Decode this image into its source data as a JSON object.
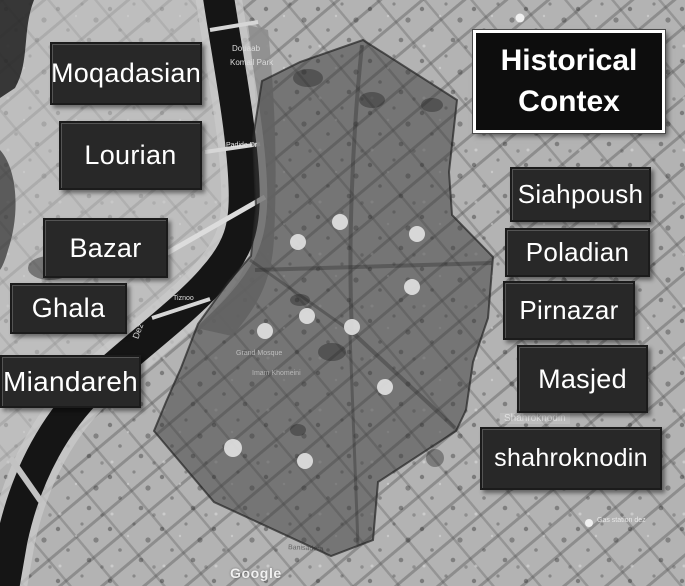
{
  "figure": {
    "title": "Historical Contex"
  },
  "regions_left": [
    {
      "name": "Moqadasian"
    },
    {
      "name": "Lourian"
    },
    {
      "name": "Bazar"
    },
    {
      "name": "Ghala"
    },
    {
      "name": "Miandareh"
    }
  ],
  "regions_right": [
    {
      "name": "Siahpoush"
    },
    {
      "name": "Poladian"
    },
    {
      "name": "Pirnazar"
    },
    {
      "name": "Masjed"
    },
    {
      "name": "shahroknodin"
    }
  ],
  "map_labels": {
    "park_line1": "Douaab",
    "park_line2": "Komail Park",
    "padide": "Padide Dr",
    "tiznoo": "Tiznoo",
    "river": "Dez",
    "mosque": "Grand Mosque",
    "khomeini": "Imam Khomeini",
    "shahroknodin_street": "Shahroknodin",
    "gas_station": "Gas station dez",
    "banisadr": "Banisadera",
    "watermark": "Google"
  },
  "markers": {
    "count": 10,
    "shape": "circle",
    "color": "#e0e0e0"
  },
  "colors": {
    "overlay_fill": "#3c3c3c",
    "label_bg": "#282828",
    "title_bg": "#0d0d0d",
    "title_border": "#ffffff",
    "label_text": "#ffffff",
    "river": "#151515",
    "map_base": "#b3b3b3"
  }
}
